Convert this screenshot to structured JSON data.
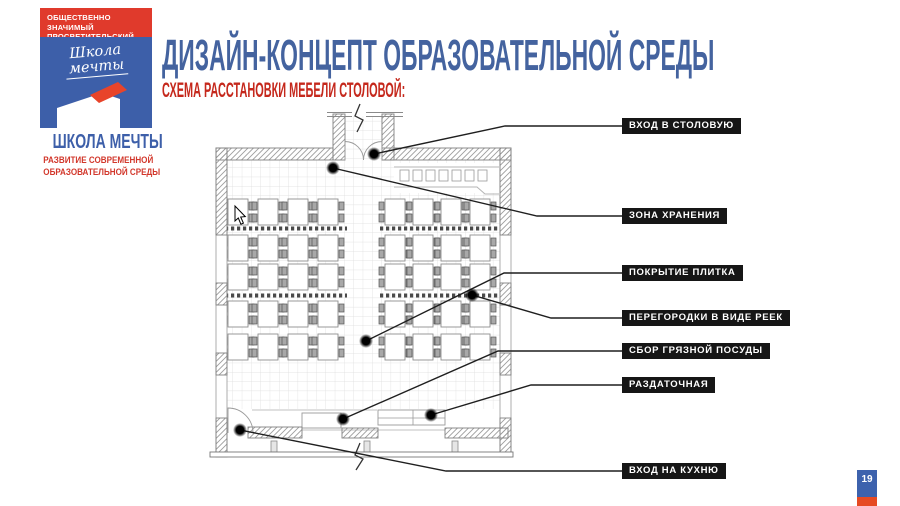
{
  "header": {
    "title": "ДИЗАЙН-КОНЦЕПТ ОБРАЗОВАТЕЛЬНОЙ СРЕДЫ",
    "subtitle": "СХЕМА РАССТАНОВКИ МЕБЕЛИ СТОЛОВОЙ:"
  },
  "logo": {
    "banner_line1": "ОБЩЕСТВЕННО ЗНАЧИМЫЙ",
    "banner_line2": "ПРОСВЕТИТЕЛЬСКИЙ ПРОЕКТ",
    "script_line1": "Школа",
    "script_line2": "мечты",
    "name": "ШКОЛА МЕЧТЫ",
    "tagline_line1": "РАЗВИТИЕ СОВРЕМЕННОЙ",
    "tagline_line2": "ОБРАЗОВАТЕЛЬНОЙ СРЕДЫ"
  },
  "callouts": [
    {
      "label": "ВХОД В СТОЛОВУЮ"
    },
    {
      "label": "ЗОНА ХРАНЕНИЯ"
    },
    {
      "label": "ПОКРЫТИЕ ПЛИТКА"
    },
    {
      "label": "ПЕРЕГОРОДКИ В ВИДЕ РЕЕК"
    },
    {
      "label": "СБОР ГРЯЗНОЙ ПОСУДЫ"
    },
    {
      "label": "РАЗДАТОЧНАЯ"
    },
    {
      "label": "ВХОД НА КУХНЮ"
    }
  ],
  "page_number": "19",
  "colors": {
    "title_blue": "#44639f",
    "subtitle_red": "#c5281c",
    "logo_red": "#e03a2c",
    "logo_blue": "#3d5fa9",
    "callout_bg": "#161616",
    "badge_blue": "#3d62ad",
    "badge_red": "#e64a22"
  }
}
